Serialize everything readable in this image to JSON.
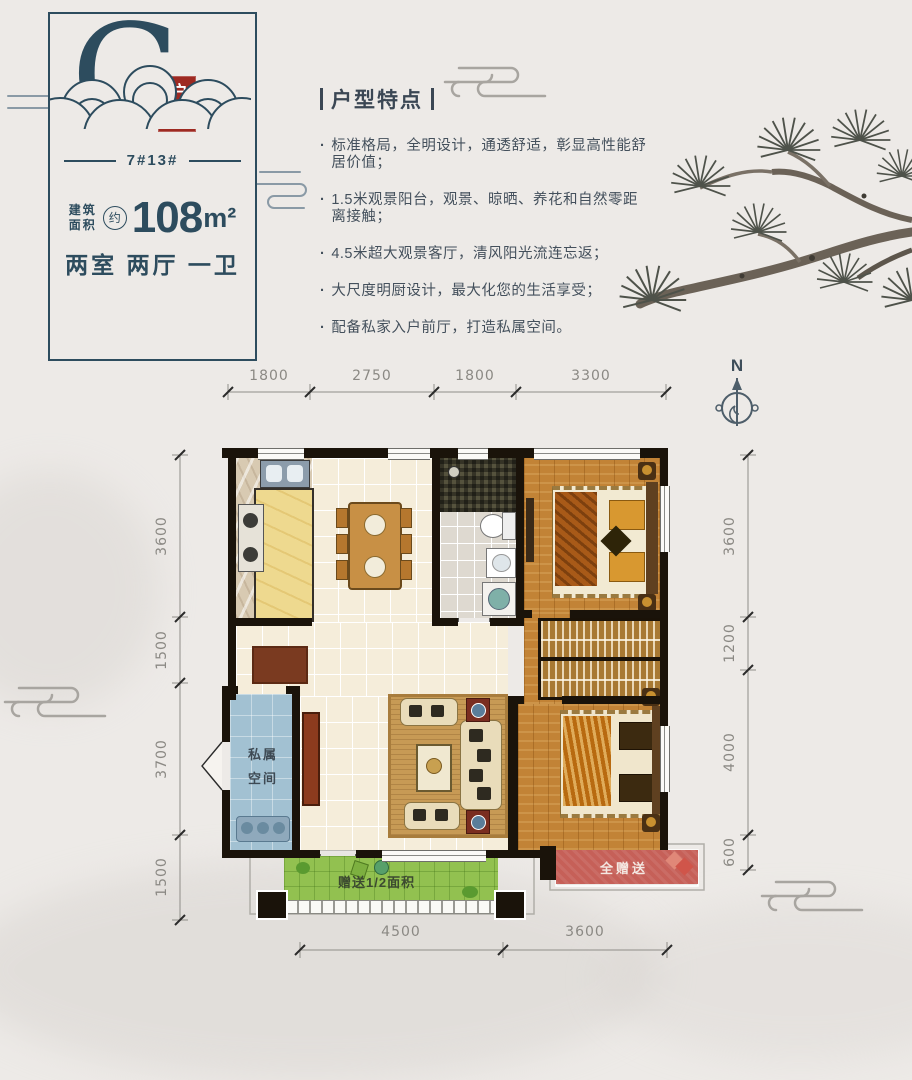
{
  "unit_card": {
    "letter": "G",
    "seal": "户型",
    "building_no": "7#13#",
    "area_label_lines": [
      "建筑",
      "面积"
    ],
    "area_approx": "约",
    "area_value": "108",
    "area_unit": "m²",
    "layout_text": "两室 两厅 一卫"
  },
  "features": {
    "title": "户型特点",
    "bullet": "·",
    "items": [
      "标准格局，全明设计，通透舒适，彰显高性能舒居价值；",
      "1.5米观景阳台，观景、晾晒、养花和自然零距离接触；",
      "4.5米超大观景客厅，清风阳光流连忘返；",
      "大尺度明厨设计，最大化您的生活享受；",
      "配备私家入户前厅，打造私属空间。"
    ]
  },
  "compass": {
    "label": "N"
  },
  "plan": {
    "dims": {
      "top": [
        "1800",
        "2750",
        "1800",
        "3300"
      ],
      "left": [
        "3600",
        "1500",
        "3700",
        "1500"
      ],
      "right": [
        "3600",
        "1200",
        "4000",
        "600"
      ],
      "bottom": [
        "4500",
        "3600"
      ]
    },
    "labels": {
      "private_lines": [
        "私属",
        "空间"
      ],
      "gift_full": "全赠送",
      "gift_half": "赠送1/2面积"
    }
  },
  "colors": {
    "accent_teal": "#2d4c5e",
    "seal_red": "#9e2a22",
    "body_text": "#44505c",
    "dim_gray": "#8b8984",
    "wall_black": "#1a130a",
    "wood": "#c28336",
    "cream_tile": "#f5edda",
    "private_blue": "#a2c1d2",
    "balcony_green": "#92c150",
    "gift_red": "#c66058",
    "counter_yellow": "#eed98f"
  }
}
